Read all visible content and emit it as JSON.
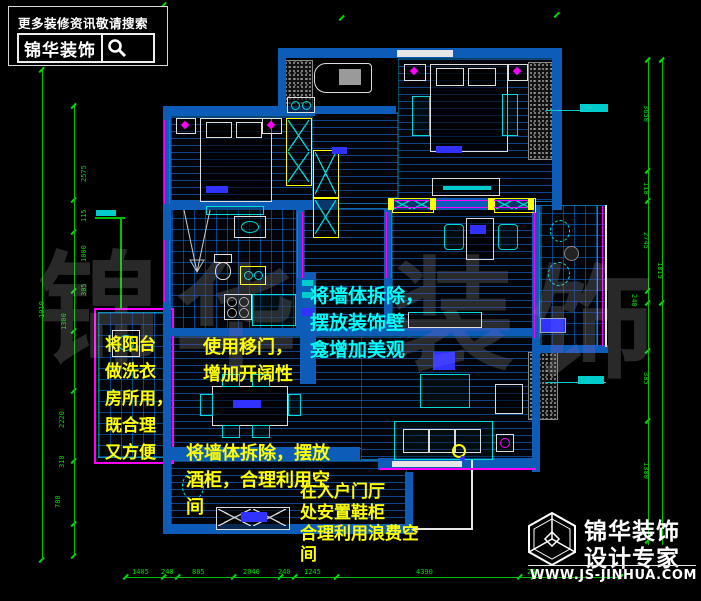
{
  "header": {
    "tagline": "更多装修资讯敬请搜索",
    "brand": "锦华装饰",
    "search_icon": "magnifier-icon"
  },
  "footer_logo": {
    "icon": "cube-hexagon-logo",
    "brand_line1": "锦华装饰",
    "brand_line2": "设计专家",
    "website": "WWW.JS-JINHUA.COM"
  },
  "watermark": {
    "chars": [
      "锦",
      "华",
      "装",
      "饰"
    ]
  },
  "annotations": {
    "niche": {
      "color": "#00ffff",
      "lines": [
        "将墙体拆除，",
        "摆放装饰壁",
        "龛增加美观"
      ]
    },
    "laundry": {
      "color": "#ffff00",
      "lines": [
        "将阳台",
        "做洗衣",
        "房所用，",
        "既合理",
        "又方便"
      ]
    },
    "sliding_door": {
      "color": "#ffff00",
      "lines": [
        "使用移门，",
        "增加开阔性"
      ]
    },
    "wine_cabinet": {
      "color": "#ffff00",
      "lines": [
        "将墙体拆除，摆放",
        "酒柜，合理利用空",
        "间"
      ]
    },
    "shoe_cabinet": {
      "color": "#ffff00",
      "lines": [
        "在入户门厅",
        "处安置鞋柜",
        "合理利用浪费空",
        "间"
      ]
    }
  },
  "dims": {
    "bottom": [
      "1405",
      "240",
      "885",
      "2040",
      "240",
      "1245",
      "4390",
      "240"
    ],
    "left": [
      "2575",
      "115",
      "1000",
      "305",
      "1300",
      "1010",
      "2220",
      "310",
      "780"
    ],
    "right": [
      "3650",
      "110",
      "2745",
      "1815",
      "240",
      "385",
      "1300"
    ]
  },
  "colors": {
    "wall_blue": "#0c5cb8",
    "dim_green": "#00dd00",
    "window_magenta": "#ff00ff",
    "cabinet_yellow": "#ffff00",
    "furniture_cyan": "#00d9d9",
    "annotation_yellow": "#ffff00",
    "annotation_cyan": "#00ffff"
  }
}
